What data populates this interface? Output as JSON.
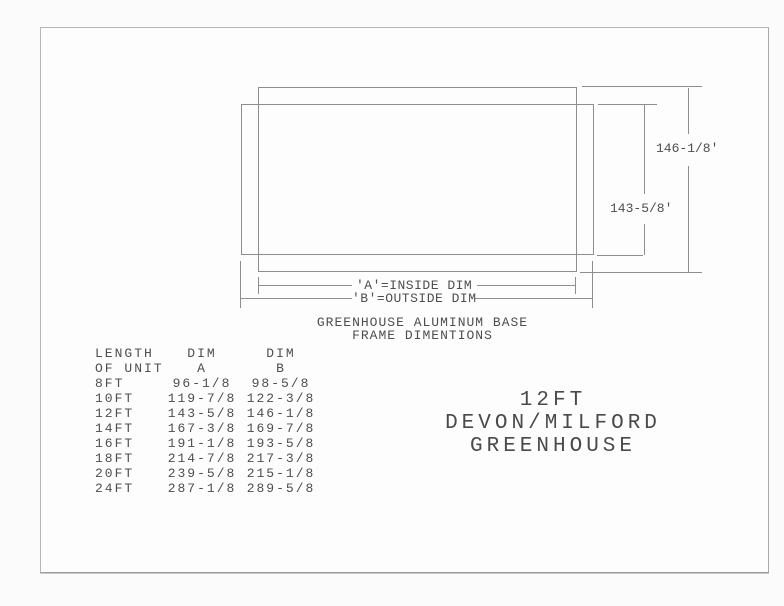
{
  "colors": {
    "line": "#8d8d8d",
    "text": "#4e4e4e",
    "paper": "#fdfdfd"
  },
  "drawing": {
    "outer_dim": "146-1/8'",
    "inner_dim": "143-5/8'",
    "inside_label": "'A'=INSIDE DIM",
    "outside_label": "'B'=OUTSIDE DIM",
    "caption_line1": "GREENHOUSE ALUMINUM BASE",
    "caption_line2": "FRAME DIMENTIONS"
  },
  "table": {
    "headers": {
      "col1a": "LENGTH",
      "col1b": "OF UNIT",
      "col2a": "DIM",
      "col2b": "A",
      "col3a": "DIM",
      "col3b": "B"
    },
    "rows": [
      {
        "length": "8FT",
        "a": "96-1/8",
        "b": "98-5/8"
      },
      {
        "length": "10FT",
        "a": "119-7/8",
        "b": "122-3/8"
      },
      {
        "length": "12FT",
        "a": "143-5/8",
        "b": "146-1/8"
      },
      {
        "length": "14FT",
        "a": "167-3/8",
        "b": "169-7/8"
      },
      {
        "length": "16FT",
        "a": "191-1/8",
        "b": "193-5/8"
      },
      {
        "length": "18FT",
        "a": "214-7/8",
        "b": "217-3/8"
      },
      {
        "length": "20FT",
        "a": "239-5/8",
        "b": "215-1/8"
      },
      {
        "length": "24FT",
        "a": "287-1/8",
        "b": "289-5/8"
      }
    ]
  },
  "title_block": {
    "line1": "12FT",
    "line2": "DEVON/MILFORD",
    "line3": "GREENHOUSE"
  }
}
